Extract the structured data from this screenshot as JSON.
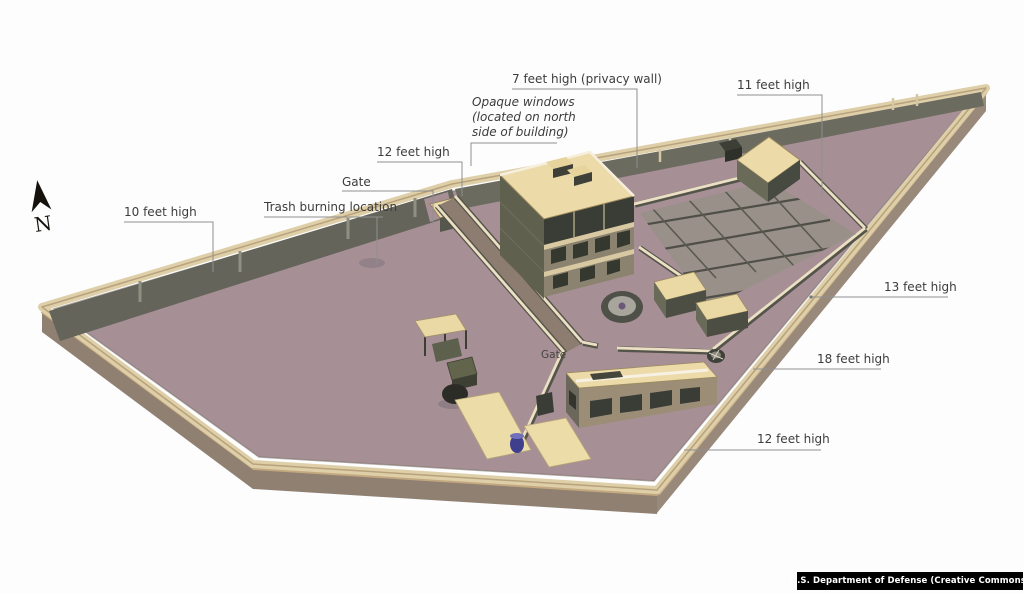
{
  "compass": {
    "label": "N"
  },
  "callouts": {
    "privacy_wall": "7 feet high (privacy wall)",
    "opaque_windows_line1": "Opaque windows",
    "opaque_windows_line2": "(located on north",
    "opaque_windows_line3": "side of building)",
    "height_11": "11 feet high",
    "height_12_nw": "12 feet high",
    "gate_north": "Gate",
    "trash": "Trash burning location",
    "height_10": "10 feet high",
    "height_13": "13 feet high",
    "height_18": "18 feet high",
    "height_12_s": "12 feet high",
    "gate_inner": "Gate"
  },
  "attribution": "U.S. Department of Defense (Creative Commons)",
  "colors": {
    "background": "#fdfdfd",
    "ground": "#a78f96",
    "wall_top": "#decfa9",
    "wall_outer": "#8f8072",
    "wall_outer_se": "#99897b",
    "wall_inner": "#64645a",
    "roof": "#ecdba9",
    "facade": "#9a9076",
    "window_dark": "#3a3d35",
    "garden": "#989089",
    "grid_line": "#4f4f47",
    "inner_wall_light": "#ece0c4",
    "attribution_bg": "#000000",
    "attribution_fg": "#ffffff",
    "label_text": "#3c3c3c"
  }
}
